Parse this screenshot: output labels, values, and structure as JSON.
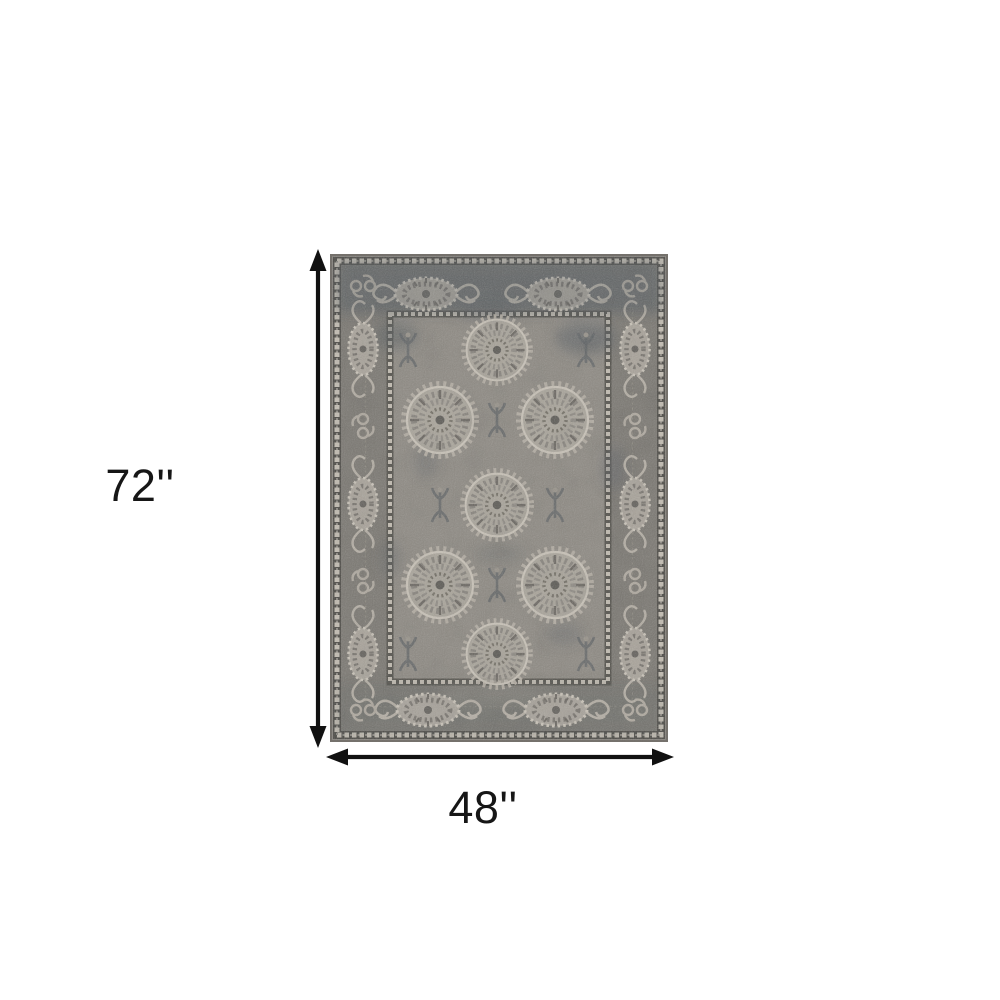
{
  "diagram": {
    "background_color": "#ffffff",
    "arrow_color": "#111111",
    "dimensions": {
      "height_label": "72''",
      "width_label": "48''"
    },
    "icons": {
      "height_arrow": "double-arrow-vertical",
      "width_arrow": "double-arrow-horizontal"
    },
    "product": {
      "name": "gray traditional medallion area rug",
      "colors": {
        "field": "#908c85",
        "border_band": "#7d7a74",
        "dark_accent": "#565c61",
        "medallion": "#b4aea4",
        "guard_cream": "#cbc5ba",
        "edge": "#6f6c66"
      }
    }
  }
}
